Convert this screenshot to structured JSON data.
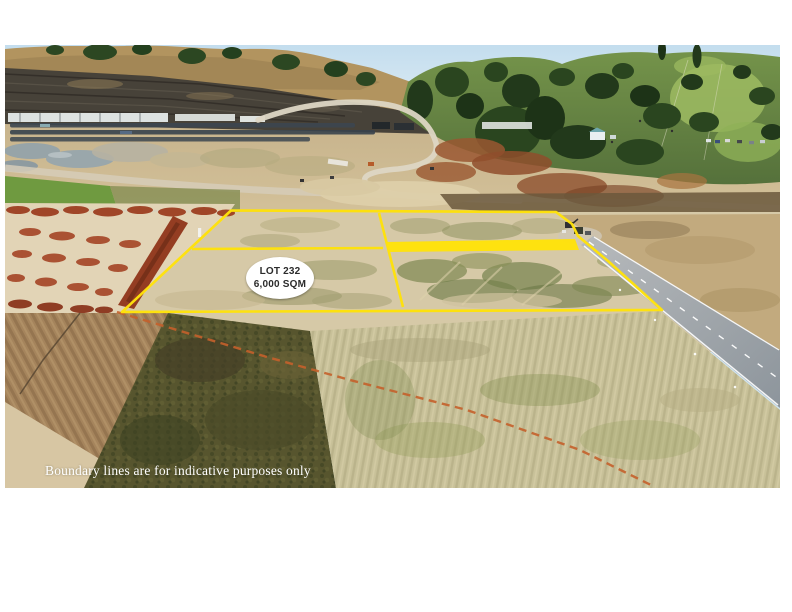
{
  "lot_label": {
    "line1": "LOT 232",
    "line2": "6,000 SQM"
  },
  "disclaimer": {
    "text": "Boundary lines are for indicative purposes only"
  },
  "colors": {
    "boundary_yellow": "#FFE20A",
    "highlight_band_yellow": "#FFE20A",
    "indicative_line_orange": "#C4602B",
    "lot_label_bg": "#FFFFFF",
    "lot_label_text": "#2B2B2B",
    "disclaimer_text": "#FFFFFF"
  }
}
